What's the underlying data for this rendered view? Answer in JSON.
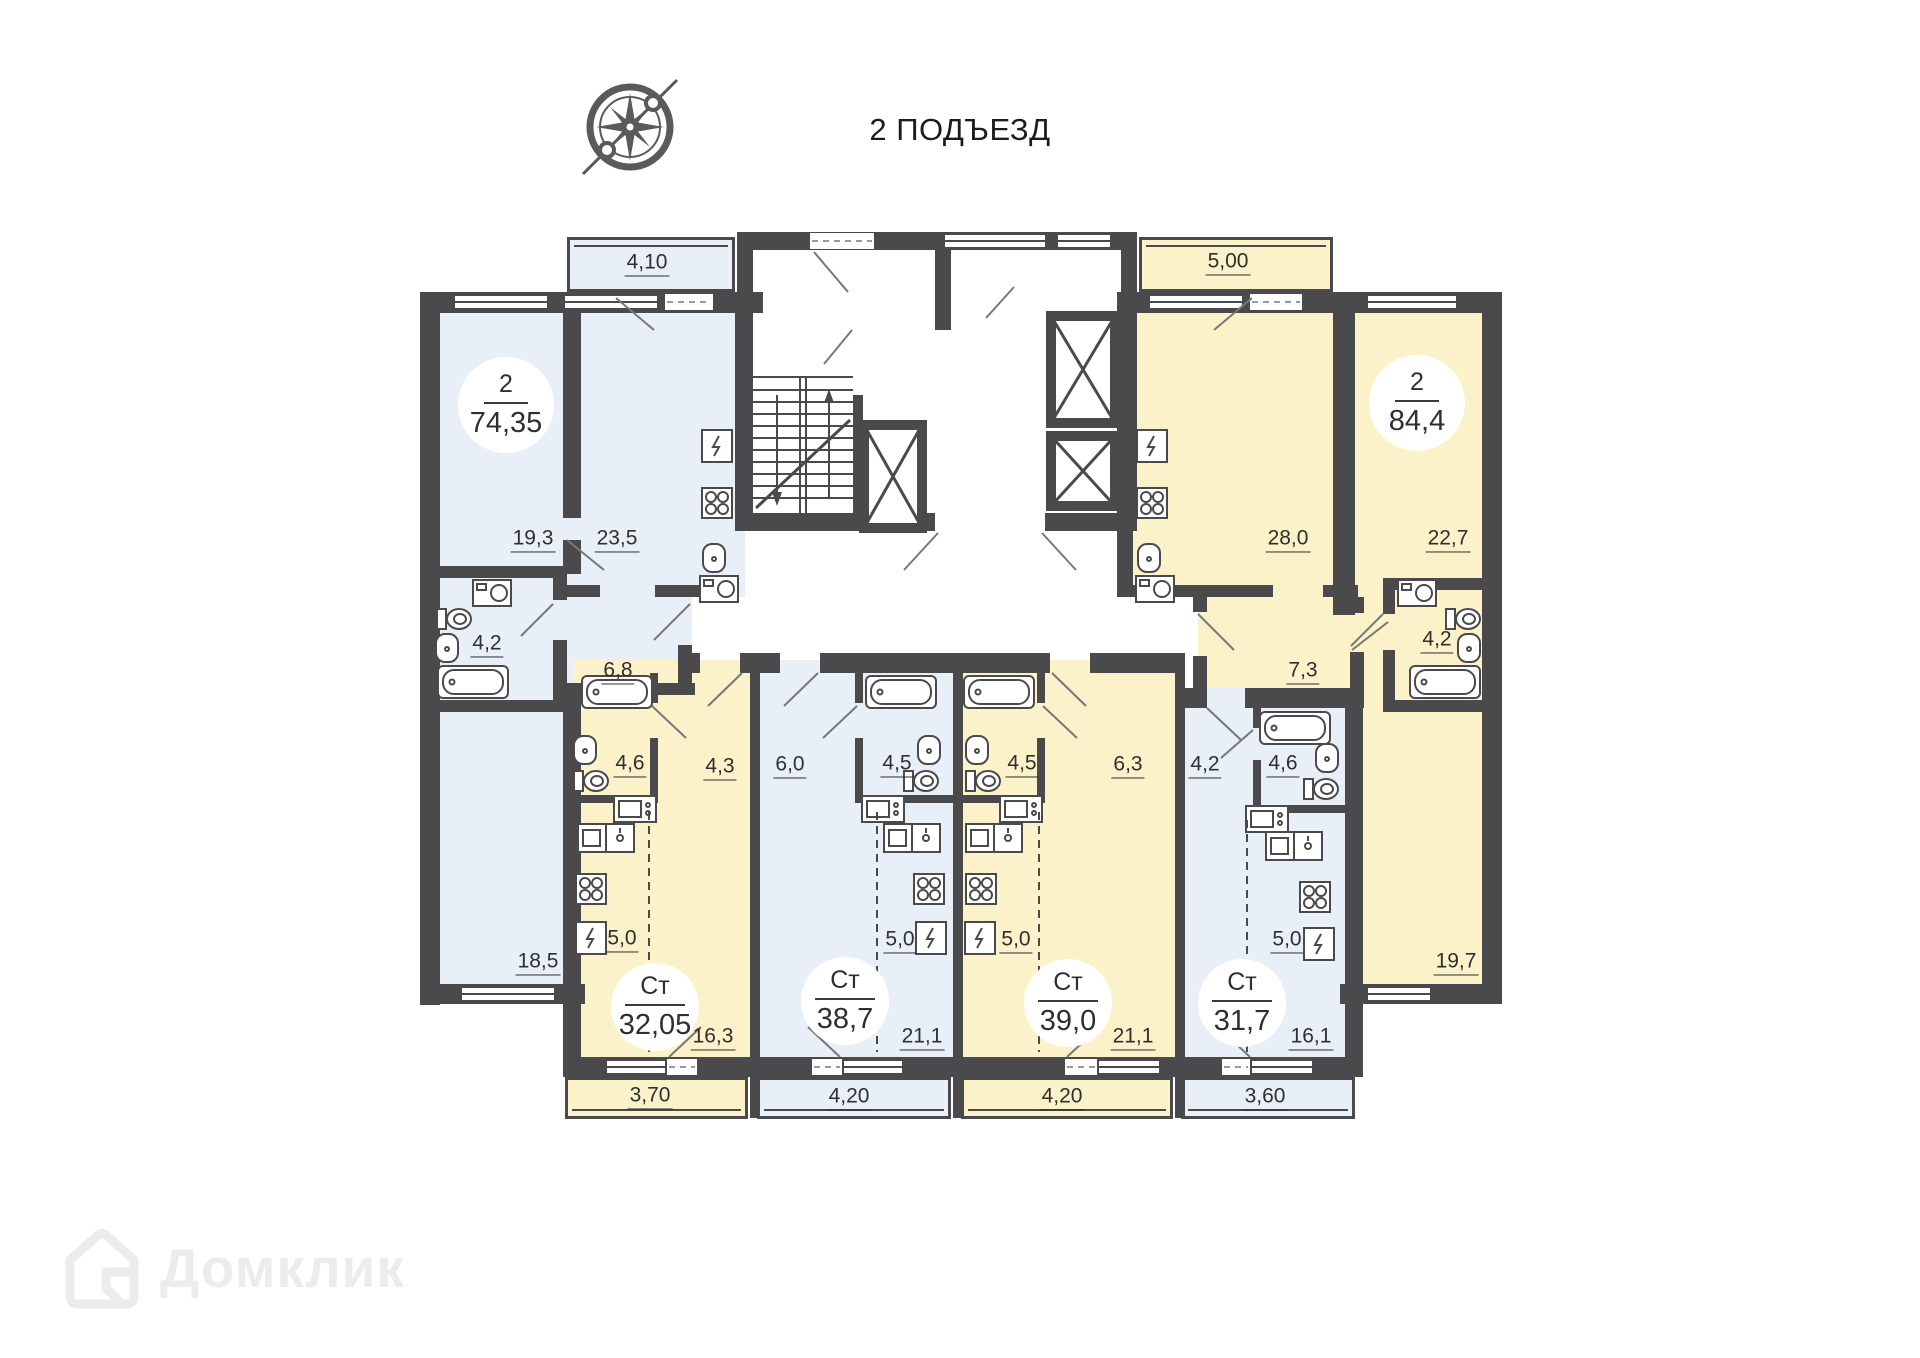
{
  "page": {
    "title": "2 ПОДЪЕЗД",
    "watermark_brand": "Домклик"
  },
  "colors": {
    "wall": "#4a4a4c",
    "fill_blue": "#e9eff7",
    "fill_yellow": "#fbf2c9",
    "badge_bg": "#ffffff",
    "label_text": "#2f2f2f",
    "watermark": "#ececec"
  },
  "apartments": [
    {
      "name": "apartment-2room-74",
      "fill": "blue",
      "badge": {
        "rooms": "2",
        "area": "74,35"
      },
      "areas": {
        "bedroom_top": "19,3",
        "kitchen_living": "23,5",
        "bathroom": "4,2",
        "hall": "6,8",
        "bedroom_bottom": "18,5",
        "balcony": "4,10"
      }
    },
    {
      "name": "apartment-2room-84",
      "fill": "yellow",
      "badge": {
        "rooms": "2",
        "area": "84,4"
      },
      "areas": {
        "kitchen_living": "28,0",
        "bedroom_top": "22,7",
        "bathroom": "4,2",
        "hall": "7,3",
        "bedroom_bottom": "19,7",
        "balcony": "5,00"
      }
    },
    {
      "name": "studio-32",
      "fill": "yellow",
      "badge": {
        "rooms": "Ст",
        "area": "32,05"
      },
      "areas": {
        "bathroom": "4,6",
        "hall": "4,3",
        "kitchen": "5,0",
        "living": "16,3",
        "balcony": "3,70"
      }
    },
    {
      "name": "studio-38",
      "fill": "blue",
      "badge": {
        "rooms": "Ст",
        "area": "38,7"
      },
      "areas": {
        "bathroom": "4,5",
        "hall": "6,0",
        "kitchen": "5,0",
        "living": "21,1",
        "balcony": "4,20"
      }
    },
    {
      "name": "studio-39",
      "fill": "yellow",
      "badge": {
        "rooms": "Ст",
        "area": "39,0"
      },
      "areas": {
        "bathroom": "4,5",
        "hall": "6,3",
        "kitchen": "5,0",
        "living": "21,1",
        "balcony": "4,20"
      }
    },
    {
      "name": "studio-31",
      "fill": "blue",
      "badge": {
        "rooms": "Ст",
        "area": "31,7"
      },
      "areas": {
        "bathroom": "4,6",
        "hall": "4,2",
        "kitchen": "5,0",
        "living": "16,1",
        "balcony": "3,60"
      }
    }
  ]
}
